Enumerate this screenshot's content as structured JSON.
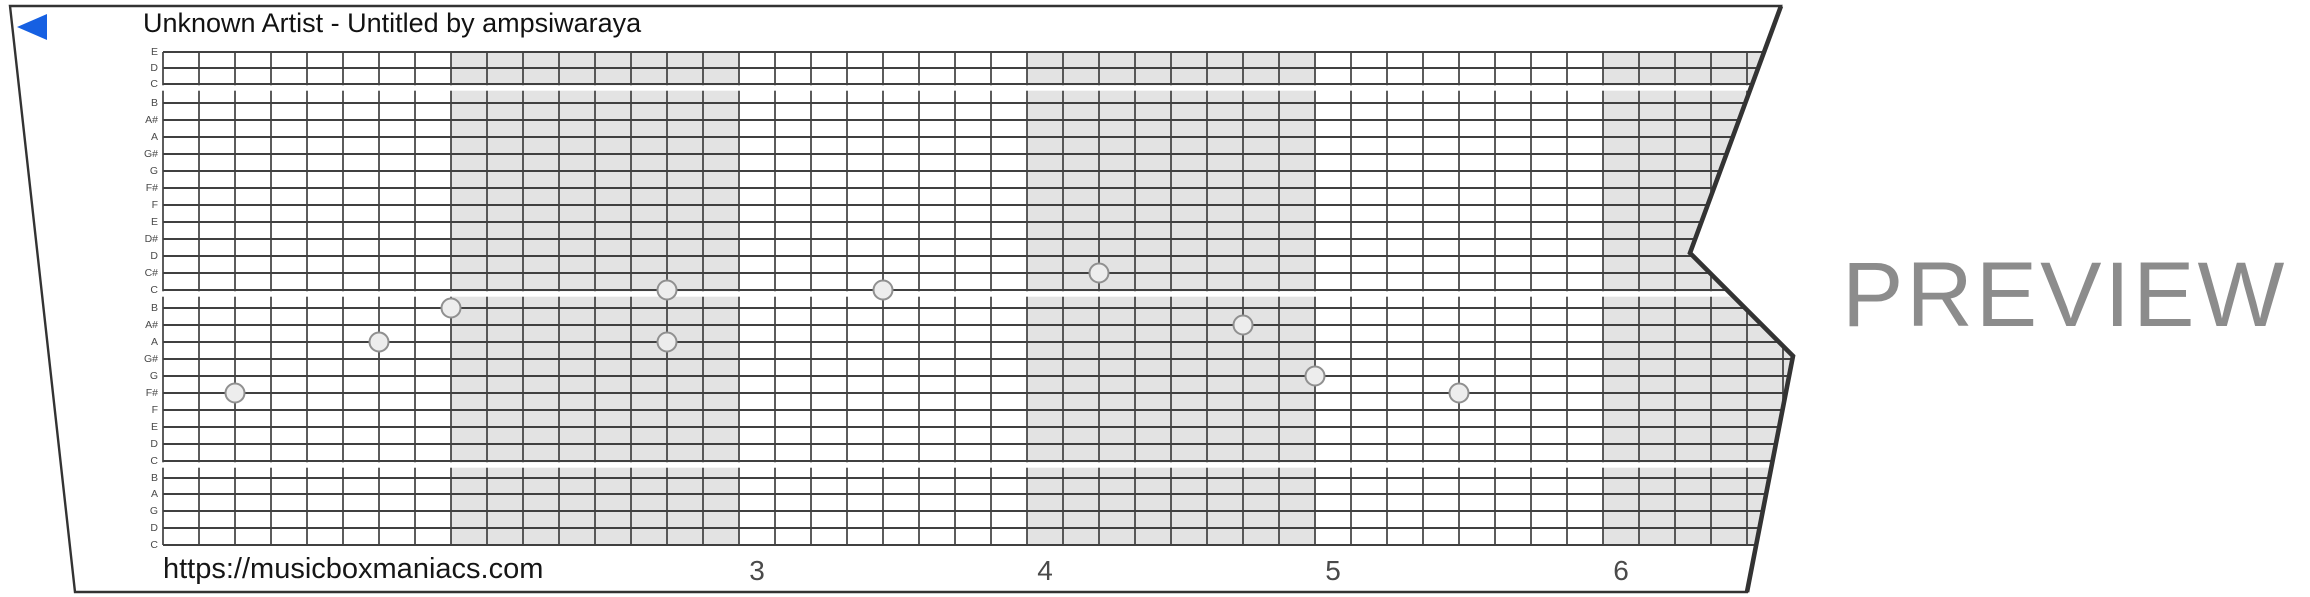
{
  "header": {
    "title": "Unknown Artist - Untitled by ampsiwaraya",
    "back_icon": "left-triangle-arrow",
    "back_color": "#1660e2"
  },
  "watermark": {
    "text": "PREVIEW",
    "color": "#8c8c8c"
  },
  "footer": {
    "url": "https://musicboxmaniacs.com"
  },
  "strip": {
    "row_labels": [
      "E",
      "D",
      "C",
      "B",
      "A#",
      "A",
      "G#",
      "G",
      "F#",
      "F",
      "E",
      "D#",
      "D",
      "C#",
      "C",
      "B",
      "A#",
      "A",
      "G#",
      "G",
      "F#",
      "F",
      "E",
      "D",
      "C",
      "B",
      "A",
      "G",
      "D",
      "C"
    ],
    "separators_after_rows": [
      2,
      14,
      24
    ],
    "bar_labels": [
      {
        "text": "3",
        "beat": 16
      },
      {
        "text": "4",
        "beat": 24
      },
      {
        "text": "5",
        "beat": 32
      },
      {
        "text": "6",
        "beat": 40
      }
    ],
    "shaded_bars": [
      {
        "start_beat": 8,
        "end_beat": 16
      },
      {
        "start_beat": 24,
        "end_beat": 32
      },
      {
        "start_beat": 40,
        "end_beat": 48
      }
    ],
    "notes": [
      {
        "pitch": "F#",
        "row": 20,
        "beat": 2
      },
      {
        "pitch": "A",
        "row": 17,
        "beat": 6
      },
      {
        "pitch": "B",
        "row": 15,
        "beat": 8
      },
      {
        "pitch": "C",
        "row": 14,
        "beat": 14
      },
      {
        "pitch": "A",
        "row": 17,
        "beat": 14
      },
      {
        "pitch": "C",
        "row": 14,
        "beat": 20
      },
      {
        "pitch": "C#",
        "row": 13,
        "beat": 26
      },
      {
        "pitch": "A#",
        "row": 16,
        "beat": 30
      },
      {
        "pitch": "G",
        "row": 19,
        "beat": 32
      },
      {
        "pitch": "F#",
        "row": 20,
        "beat": 36
      }
    ],
    "colors": {
      "shading": "#e3e3e3",
      "grid_line": "#404040",
      "edge": "#333333",
      "note_fill": "#ededed",
      "note_stroke": "#909090"
    }
  }
}
